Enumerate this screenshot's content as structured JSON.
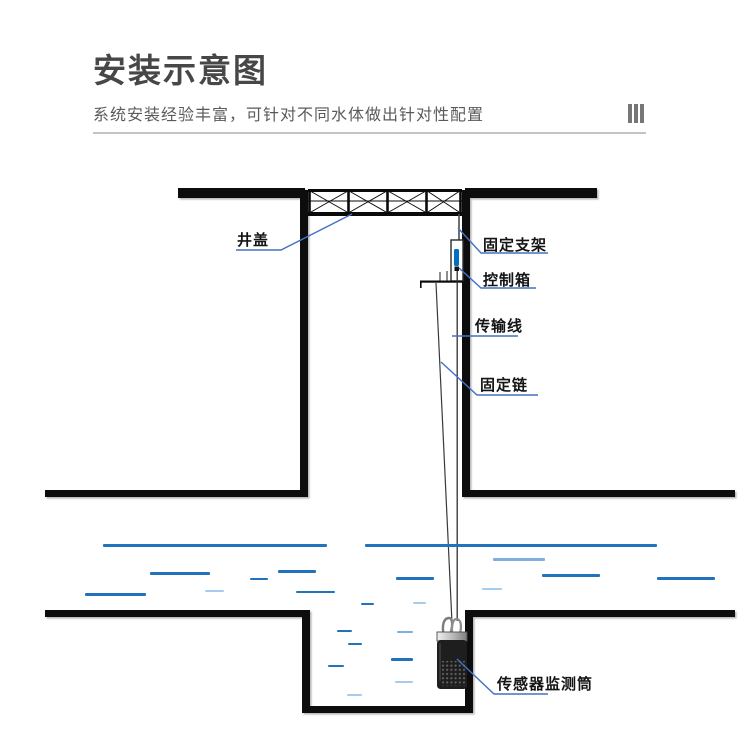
{
  "header": {
    "title": "安装示意图",
    "subtitle": "系统安装经验丰富，可针对不同水体做出针对性配置"
  },
  "diagram": {
    "labels": {
      "manhole_cover": "井盖",
      "fixed_bracket": "固定支架",
      "control_box": "控制箱",
      "transmission_line": "传输线",
      "fixed_chain": "固定链",
      "sensor_cylinder": "传感器监测筒"
    },
    "colors": {
      "leader_blue": "#4472C4",
      "structure_black": "#0a0a0a",
      "control_box_blue": "#0070C0",
      "water_dark": "#2273BE",
      "water_mid": "#7FAFE0",
      "water_light": "#A6CBEC"
    },
    "water_dashes": [
      {
        "x": 103,
        "w": 224,
        "y": 544,
        "shade": "dark",
        "t": 2.5
      },
      {
        "x": 365,
        "w": 292,
        "y": 544,
        "shade": "dark",
        "t": 2.5
      },
      {
        "x": 150,
        "w": 60,
        "y": 572,
        "shade": "dark",
        "t": 2.5
      },
      {
        "x": 278,
        "w": 38,
        "y": 570,
        "shade": "dark",
        "t": 2.5
      },
      {
        "x": 250,
        "w": 18,
        "y": 578,
        "shade": "dark",
        "t": 1.5
      },
      {
        "x": 205,
        "w": 19,
        "y": 590,
        "shade": "light",
        "t": 2
      },
      {
        "x": 85,
        "w": 61,
        "y": 593,
        "shade": "dark",
        "t": 2.5
      },
      {
        "x": 296,
        "w": 39,
        "y": 591,
        "shade": "dark",
        "t": 2
      },
      {
        "x": 361,
        "w": 13,
        "y": 603,
        "shade": "dark",
        "t": 1.5
      },
      {
        "x": 493,
        "w": 52,
        "y": 558,
        "shade": "mid",
        "t": 2.5
      },
      {
        "x": 396,
        "w": 38,
        "y": 577,
        "shade": "dark",
        "t": 2.5
      },
      {
        "x": 542,
        "w": 58,
        "y": 574,
        "shade": "dark",
        "t": 2.5
      },
      {
        "x": 657,
        "w": 58,
        "y": 577,
        "shade": "dark",
        "t": 2.5
      },
      {
        "x": 482,
        "w": 20,
        "y": 588,
        "shade": "light",
        "t": 2
      },
      {
        "x": 413,
        "w": 13,
        "y": 602,
        "shade": "light",
        "t": 1.5
      },
      {
        "x": 337,
        "w": 15,
        "y": 630,
        "shade": "dark",
        "t": 2
      },
      {
        "x": 397,
        "w": 16,
        "y": 631,
        "shade": "mid",
        "t": 2
      },
      {
        "x": 348,
        "w": 14,
        "y": 643,
        "shade": "dark",
        "t": 1.5
      },
      {
        "x": 328,
        "w": 16,
        "y": 665,
        "shade": "dark",
        "t": 2
      },
      {
        "x": 391,
        "w": 22,
        "y": 658,
        "shade": "dark",
        "t": 2.5
      },
      {
        "x": 395,
        "w": 18,
        "y": 681,
        "shade": "light",
        "t": 2
      },
      {
        "x": 347,
        "w": 15,
        "y": 694,
        "shade": "light",
        "t": 2
      }
    ]
  }
}
